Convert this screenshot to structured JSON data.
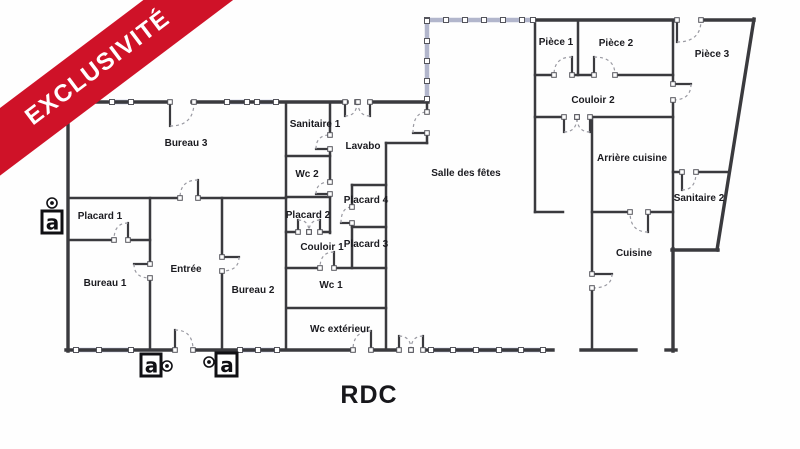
{
  "ribbon": {
    "label": "EXCLUSIVITÉ"
  },
  "plan": {
    "title": "RDC",
    "colors": {
      "ribbon": "#cf1228",
      "wall": "#3a3a3e",
      "window": "#b2b6cc",
      "arc": "#9a9aa2"
    },
    "rooms": [
      {
        "label": "Bureau 3"
      },
      {
        "label": "Sanitaire 1"
      },
      {
        "label": "Lavabo"
      },
      {
        "label": "Wc 2"
      },
      {
        "label": "Placard 1"
      },
      {
        "label": "Placard 2"
      },
      {
        "label": "Placard 4"
      },
      {
        "label": "Couloir 1"
      },
      {
        "label": "Placard 3"
      },
      {
        "label": "Entrée"
      },
      {
        "label": "Bureau 1"
      },
      {
        "label": "Bureau 2"
      },
      {
        "label": "Wc 1"
      },
      {
        "label": "Wc extérieur"
      },
      {
        "label": "Salle des fêtes"
      },
      {
        "label": "Pièce 1"
      },
      {
        "label": "Pièce 2"
      },
      {
        "label": "Pièce 3"
      },
      {
        "label": "Couloir 2"
      },
      {
        "label": "Arrière cuisine"
      },
      {
        "label": "Sanitaire 2"
      },
      {
        "label": "Cuisine"
      }
    ],
    "markers": [
      {
        "label": "a"
      },
      {
        "label": "a"
      },
      {
        "label": "a"
      }
    ]
  }
}
